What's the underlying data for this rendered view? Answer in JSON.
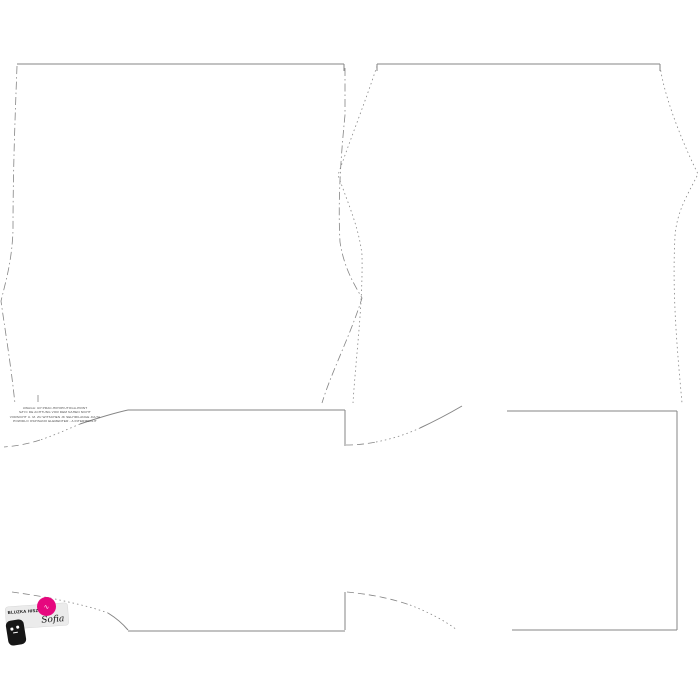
{
  "canvas": {
    "width": 700,
    "height": 700,
    "background": "#ffffff",
    "line_color": "#858585"
  },
  "note": {
    "lines": [
      "UWAGA: UP PRAC-HIPOPIUTOGA-PRINT",
      "SZYC DE ACHTUNG VOR DEM NAHEN NICHT",
      "VORSICHT U. M. ZU WITSCHEN JK SELHRILANGE JULTA",
      "POWIDLO OSPISANO ELEMENTER - A INTERMEDLIT"
    ]
  },
  "logo": {
    "label_name": "BLUZKA HISZPANKA",
    "label_script": "Sofia",
    "badge_color": "#e6077e",
    "badge_glyph": "∿"
  },
  "drawing": {
    "pieces": [
      {
        "name": "piece-a-top-edge",
        "style": "solid",
        "d": "M17,64 H344"
      },
      {
        "name": "piece-a-corner-tick-right",
        "style": "solid",
        "d": "M344,64 V71"
      },
      {
        "name": "piece-a-left-edge",
        "style": "dashdot",
        "d": "M17,66 C15,120 13,170 13,230 C12,262 5,284 1,301 C5,330 11,365 15,404"
      },
      {
        "name": "piece-a-right-edge",
        "style": "dashdot",
        "d": "M345,68 L345,115 C340,165 338,205 340,242 C344,268 354,284 362,298 C351,334 331,373 322,403"
      },
      {
        "name": "piece-a-stray-mark",
        "style": "dash",
        "d": "M38,395 V403"
      },
      {
        "name": "piece-b-top-edge",
        "style": "solid",
        "d": "M377,64 H660"
      },
      {
        "name": "piece-b-corner-tick-left",
        "style": "solid",
        "d": "M377,64 V71"
      },
      {
        "name": "piece-b-corner-tick-right",
        "style": "solid",
        "d": "M660,64 V71"
      },
      {
        "name": "piece-b-left-edge",
        "style": "dot",
        "d": "M377,66 C366,100 350,140 338,175 C349,206 359,228 362,255 C363,305 356,355 353,403"
      },
      {
        "name": "piece-b-right-edge",
        "style": "dot",
        "d": "M660,66 C665,102 687,152 698,174 C687,196 677,211 675,236 C672,292 677,348 682,403"
      },
      {
        "name": "piece-c-top-edge",
        "style": "solid",
        "d": "M128,410 H345"
      },
      {
        "name": "piece-c-left-curve-solid",
        "style": "solid",
        "d": "M128,410 C110,414 95,419 80,424"
      },
      {
        "name": "piece-c-left-curve-dot",
        "style": "dot",
        "d": "M80,424 C66,430 52,436 40,440"
      },
      {
        "name": "piece-c-left-curve-dash",
        "style": "dash",
        "d": "M40,440 C28,444 16,446 4,447"
      },
      {
        "name": "piece-c-right-edge",
        "style": "solid",
        "d": "M345,410 V446"
      },
      {
        "name": "piece-d-neck-curve-dash",
        "style": "dash",
        "d": "M346,445 C356,445 366,444 376,442"
      },
      {
        "name": "piece-d-neck-curve-dot",
        "style": "dot",
        "d": "M376,442 C392,439 407,434 420,428"
      },
      {
        "name": "piece-d-neck-curve-solid",
        "style": "solid",
        "d": "M420,428 C435,421 450,413 462,406"
      },
      {
        "name": "piece-e-top-edge",
        "style": "solid",
        "d": "M507,411 H677"
      },
      {
        "name": "piece-e-right-edge",
        "style": "solid",
        "d": "M677,411 V630"
      },
      {
        "name": "piece-e-bottom-edge",
        "style": "solid",
        "d": "M512,630 H677"
      },
      {
        "name": "piece-f-left-curve-dash",
        "style": "dash",
        "d": "M12,592 C26,594 40,596 55,599"
      },
      {
        "name": "piece-f-left-curve-dot",
        "style": "dot",
        "d": "M55,599 C73,603 92,607 108,613"
      },
      {
        "name": "piece-f-left-curve-solid",
        "style": "solid",
        "d": "M108,613 C116,618 123,624 128,630"
      },
      {
        "name": "piece-f-top-edge",
        "style": "solid",
        "d": "M128,631 H345"
      },
      {
        "name": "piece-g-left-edge",
        "style": "solid",
        "d": "M345,592 V630"
      },
      {
        "name": "piece-g-curve-dash",
        "style": "dash",
        "d": "M347,592 C368,594 390,598 410,605"
      },
      {
        "name": "piece-g-curve-dot",
        "style": "dot",
        "d": "M410,605 C428,612 444,620 457,630"
      }
    ]
  }
}
